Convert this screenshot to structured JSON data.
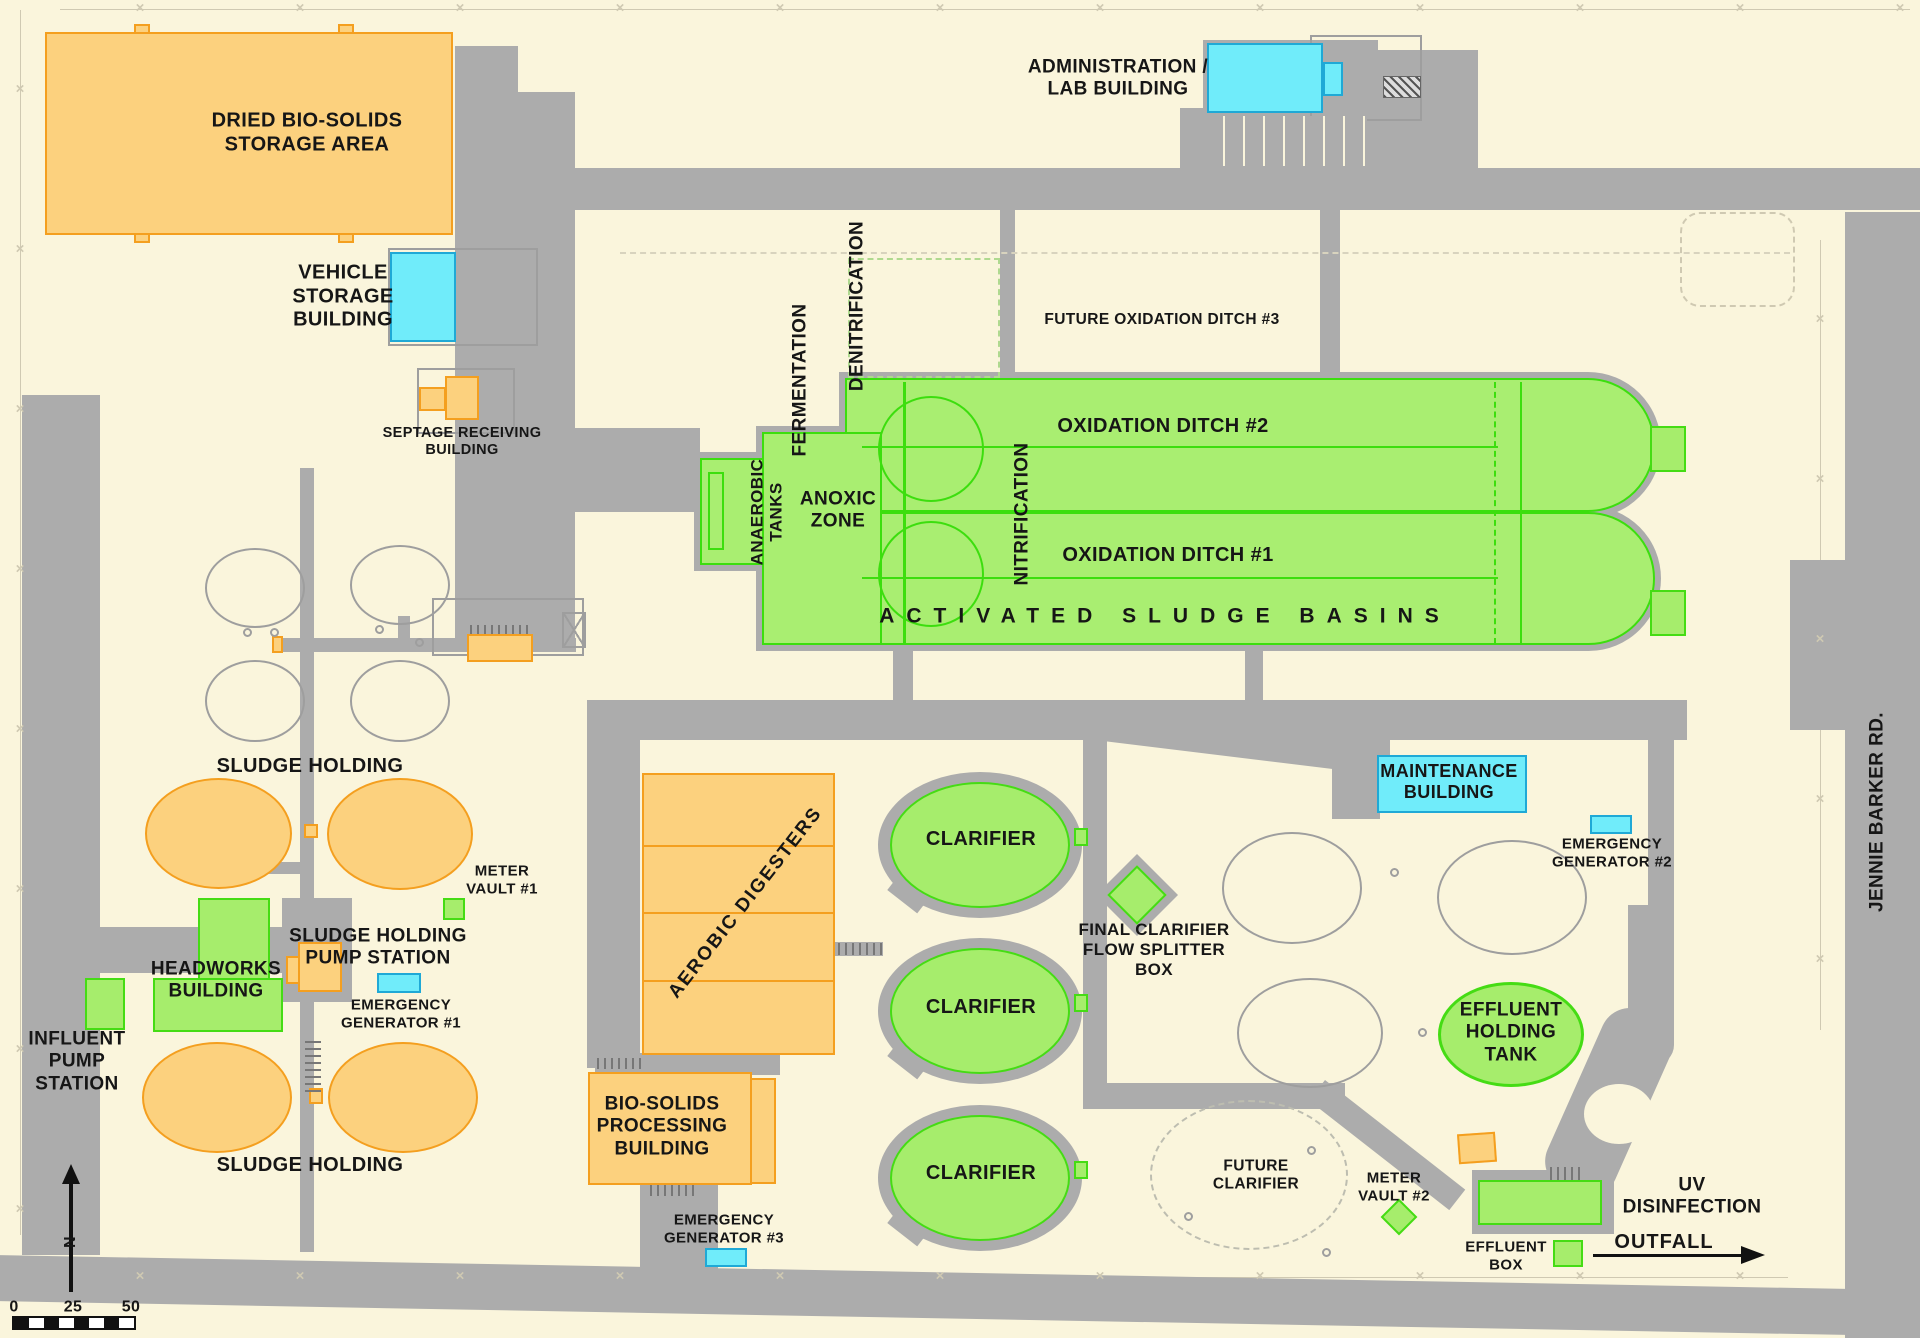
{
  "colors": {
    "background": "#FAF5DC",
    "road": "#ACACAC",
    "building_orange": "#FCD17E",
    "building_orange_border": "#F49F1F",
    "building_cyan": "#70ECFA",
    "building_cyan_border": "#1FA9D6",
    "building_green": "#A6ED6C",
    "building_green_border": "#45DC14",
    "basin_green": "#A9EE71",
    "basin_line_green": "#3CDE0E",
    "outline_gray": "#9E9E9E",
    "fence": "#CFC9B2",
    "ink": "#161616"
  },
  "labels": {
    "dried_biosolids": "DRIED BIO-SOLIDS\nSTORAGE AREA",
    "vehicle_storage": "VEHICLE\nSTORAGE\nBUILDING",
    "septage_receiving": "SEPTAGE RECEIVING\nBUILDING",
    "administration_lab": "ADMINISTRATION /\nLAB BUILDING",
    "fermentation": "FERMENTATION",
    "denitrification": "DENITRIFICATION",
    "future_oxidation_ditch_3": "FUTURE OXIDATION DITCH #3",
    "oxidation_ditch_2": "OXIDATION DITCH #2",
    "oxidation_ditch_1": "OXIDATION DITCH #1",
    "nitrification": "NITRIFICATION",
    "anaerobic_tanks": "ANAEROBIC\nTANKS",
    "anoxic_zone": "ANOXIC\nZONE",
    "activated_sludge_basins": "ACTIVATED SLUDGE BASINS",
    "sludge_holding_upper": "SLUDGE HOLDING",
    "sludge_holding_lower": "SLUDGE HOLDING",
    "meter_vault_1": "METER\nVAULT #1",
    "sludge_holding_pump_station": "SLUDGE HOLDING\nPUMP STATION",
    "headworks_building": "HEADWORKS\nBUILDING",
    "emergency_generator_1": "EMERGENCY\nGENERATOR #1",
    "influent_pump_station": "INFLUENT\nPUMP\nSTATION",
    "aerobic_digesters": "AEROBIC  DIGESTERS",
    "bio_solids_processing": "BIO-SOLIDS\nPROCESSING\nBUILDING",
    "emergency_generator_3": "EMERGENCY\nGENERATOR #3",
    "clarifier": "CLARIFIER",
    "final_clarifier_flow_splitter_box": "FINAL CLARIFIER\nFLOW SPLITTER\nBOX",
    "future_clarifier": "FUTURE\nCLARIFIER",
    "maintenance_building": "MAINTENANCE\nBUILDING",
    "emergency_generator_2": "EMERGENCY\nGENERATOR #2",
    "effluent_holding_tank": "EFFLUENT\nHOLDING\nTANK",
    "meter_vault_2": "METER\nVAULT #2",
    "uv_disinfection": "UV\nDISINFECTION",
    "effluent_box": "EFFLUENT\nBOX",
    "outfall": "OUTFALL",
    "jennie_barker_rd": "JENNIE BARKER RD."
  },
  "scale_bar": {
    "tick_0": "0",
    "tick_25": "25",
    "tick_50": "50"
  },
  "north_indicator": {
    "letter": "N"
  }
}
